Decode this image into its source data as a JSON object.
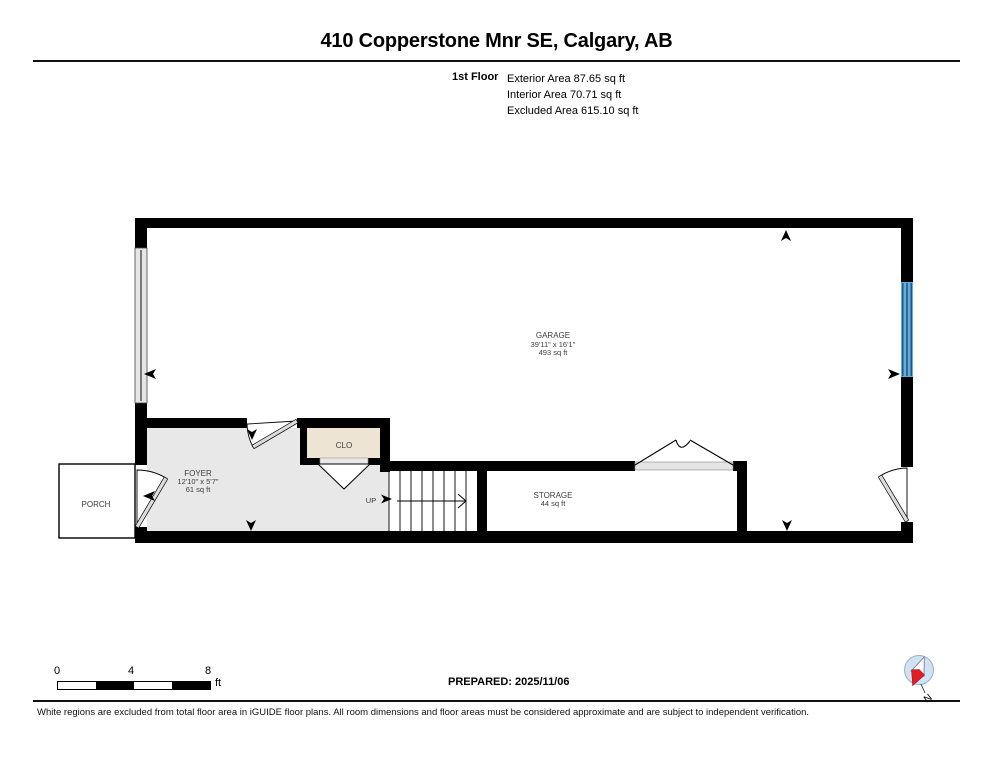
{
  "header": {
    "title": "410 Copperstone Mnr SE, Calgary, AB",
    "floor_label": "1st Floor",
    "exterior_area": "Exterior Area 87.65 sq ft",
    "interior_area": "Interior Area 70.71 sq ft",
    "excluded_area": "Excluded Area 615.10 sq ft"
  },
  "rooms": {
    "garage": {
      "name": "GARAGE",
      "dims": "39'11\" x 16'1\"",
      "area": "493 sq ft"
    },
    "foyer": {
      "name": "FOYER",
      "dims": "12'10\" x 5'7\"",
      "area": "61 sq ft"
    },
    "closet": {
      "name": "CLO"
    },
    "storage": {
      "name": "STORAGE",
      "area": "44 sq ft"
    },
    "porch": {
      "name": "PORCH"
    },
    "stairs": {
      "direction_label": "UP"
    }
  },
  "footer": {
    "scale": {
      "ticks": [
        "0",
        "4",
        "8"
      ],
      "unit": "ft"
    },
    "prepared": "PREPARED: 2025/11/06",
    "compass_label": "N",
    "disclaimer": "White regions are excluded from total floor area in iGUIDE floor plans. All room dimensions and floor areas must be considered approximate and are subject to independent verification."
  },
  "colors": {
    "wall": "#000000",
    "foyer_fill": "#e8e8e8",
    "closet_fill": "#ede4d3",
    "closet_sill": "#e8e8e8",
    "storage_sill": "#e4e4e4",
    "window_grey": "#e6e6e6",
    "window_blue": "#64aede",
    "window_blue_line": "#1d4d79",
    "door_leaf": "#dcdcdc",
    "compass_bg": "#cfe3f5",
    "compass_needle_red": "#e31b23",
    "label_text": "#3c3c3c"
  }
}
